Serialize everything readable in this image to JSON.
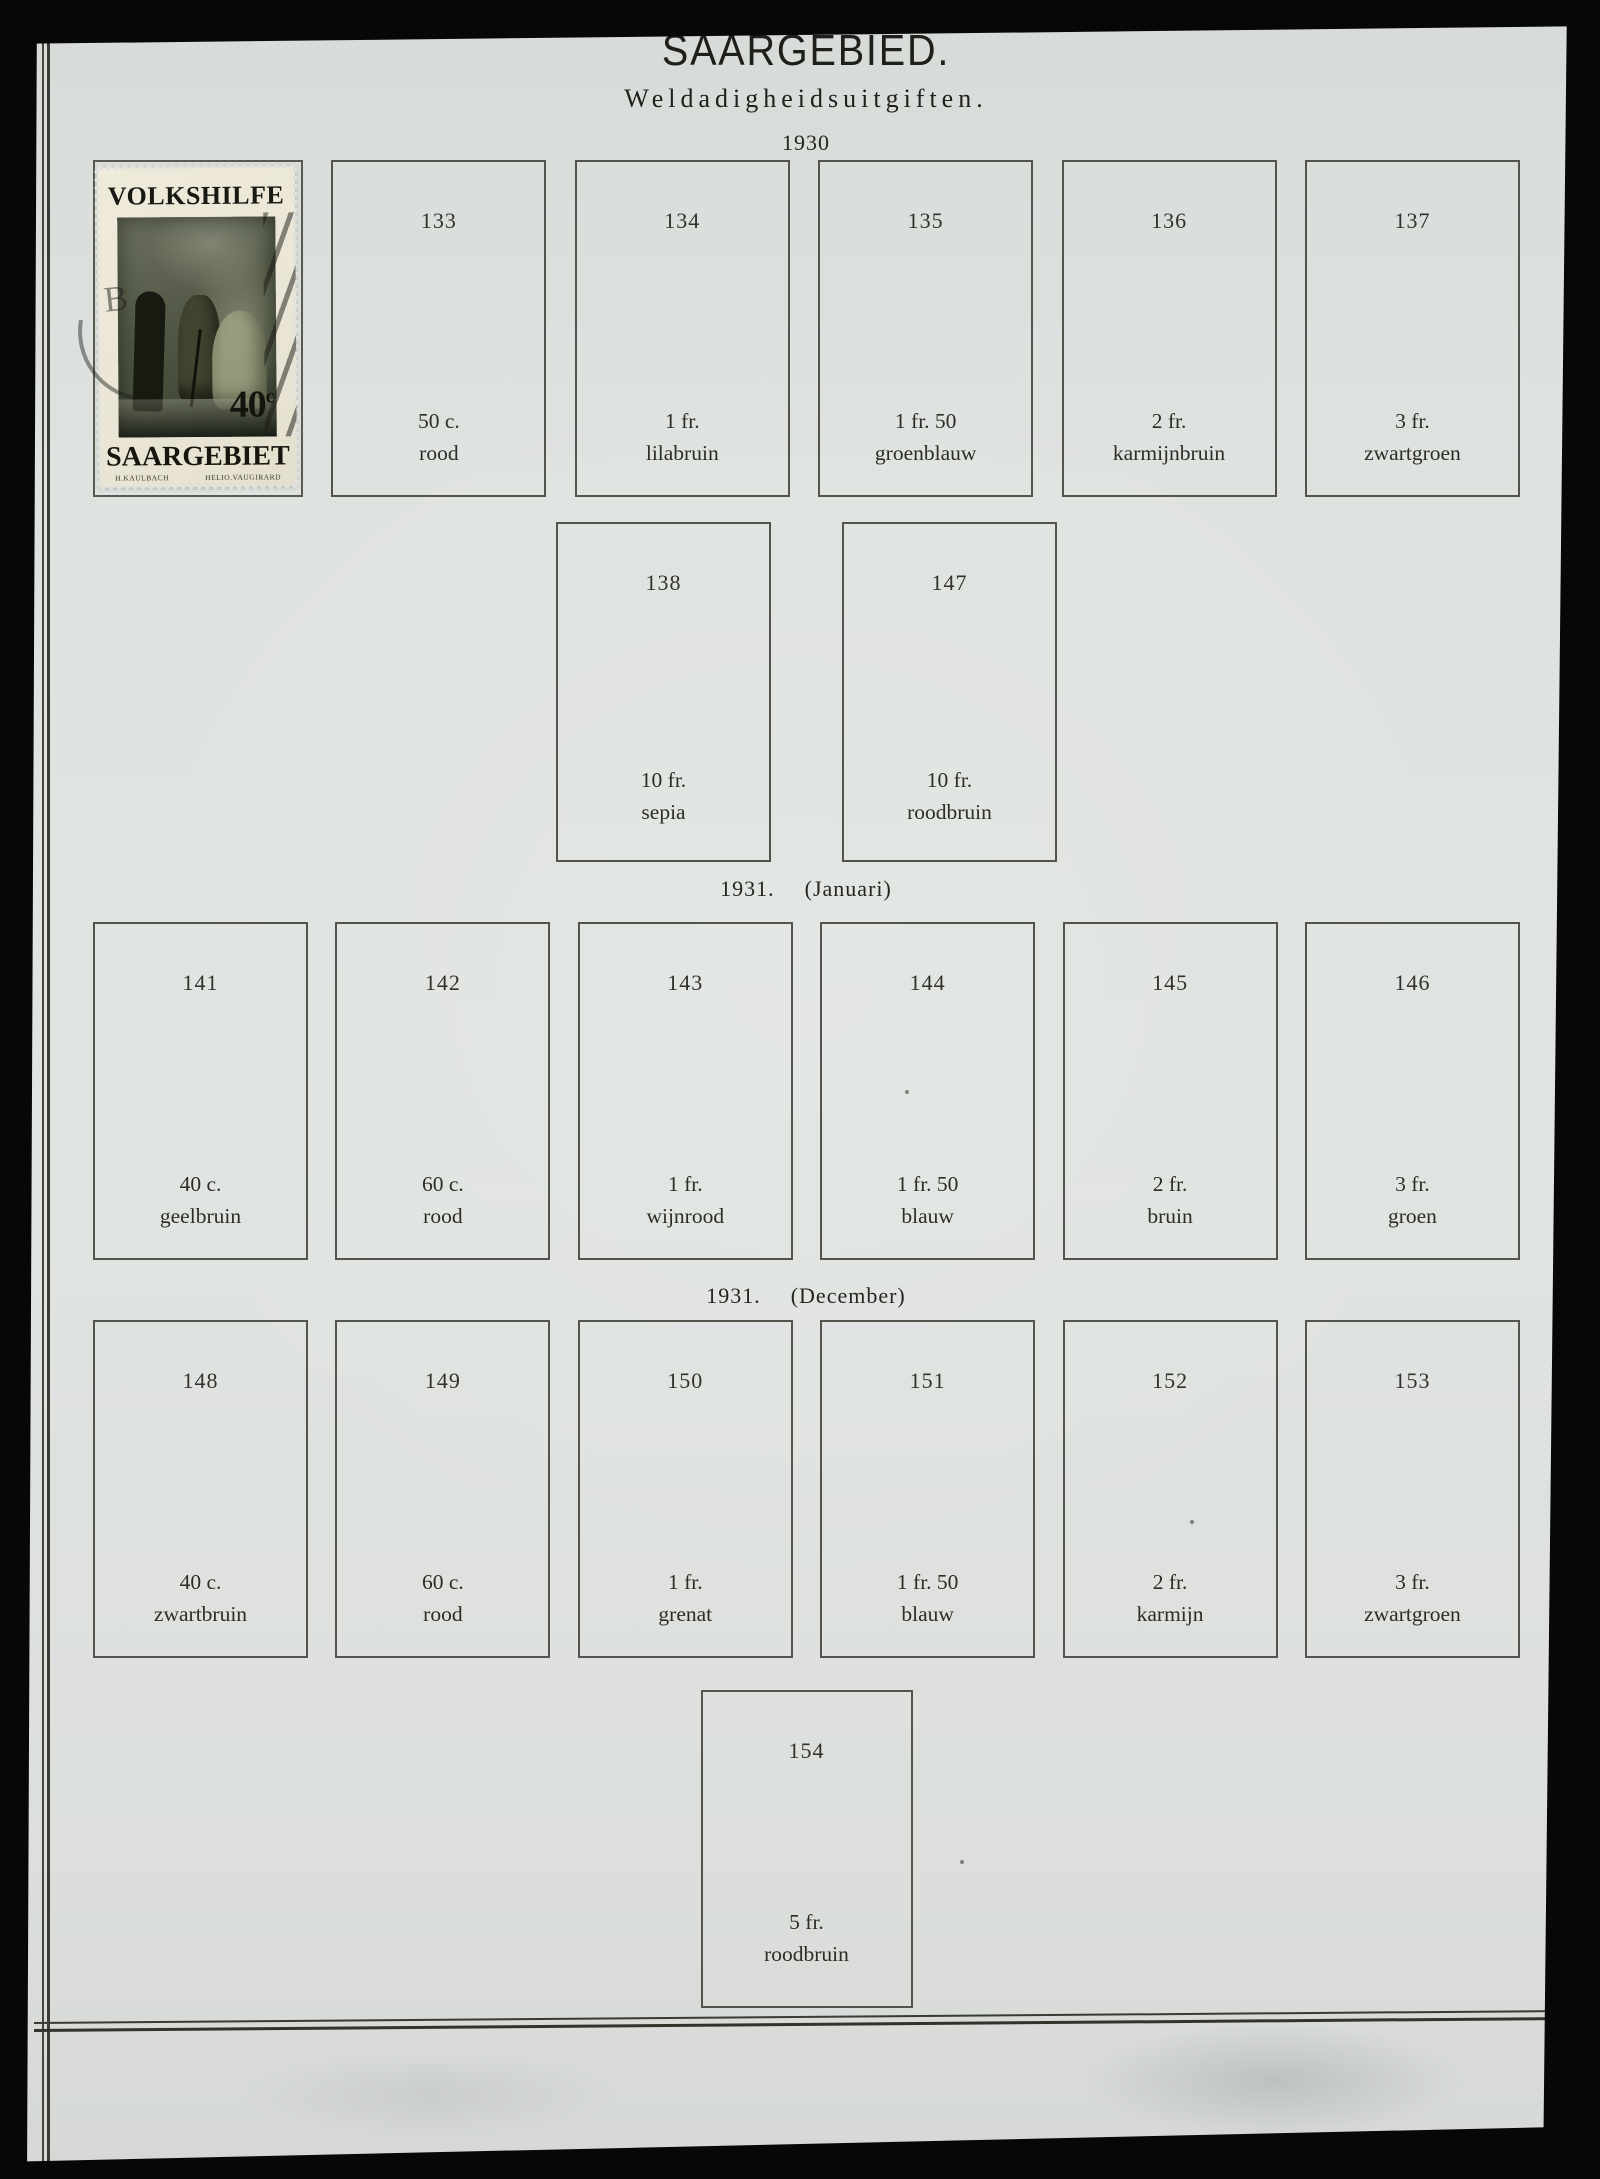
{
  "page": {
    "title": "SAARGEBIED.",
    "subtitle": "Weldadigheidsuitgiften.",
    "paper_color": "#dee2df",
    "ink_color": "#2d2d25",
    "box_border_color": "#55544c"
  },
  "stamp": {
    "top_text": "VOLKSHILFE",
    "denomination_value": "40",
    "denomination_unit": "c",
    "bottom_text": "SAARGEBIET",
    "imprint_left": "H.KAULBACH",
    "imprint_right": "HELIO.VAUGIRARD",
    "cancellation_letter": "B",
    "paper_color": "#ebe6d6",
    "image_color": "#4d5443"
  },
  "sections": [
    {
      "year_label": "1930",
      "rows": [
        {
          "boxes": [
            {
              "number": "133",
              "line1": "50 c.",
              "line2": "rood"
            },
            {
              "number": "134",
              "line1": "1 fr.",
              "line2": "lilabruin"
            },
            {
              "number": "135",
              "line1": "1 fr. 50",
              "line2": "groenblauw"
            },
            {
              "number": "136",
              "line1": "2 fr.",
              "line2": "karmijnbruin"
            },
            {
              "number": "137",
              "line1": "3 fr.",
              "line2": "zwartgroen"
            }
          ]
        },
        {
          "boxes": [
            {
              "number": "138",
              "line1": "10 fr.",
              "line2": "sepia"
            },
            {
              "number": "147",
              "line1": "10 fr.",
              "line2": "roodbruin"
            }
          ]
        }
      ]
    },
    {
      "year_label": "1931.",
      "month_label": "(Januari)",
      "rows": [
        {
          "boxes": [
            {
              "number": "141",
              "line1": "40 c.",
              "line2": "geelbruin"
            },
            {
              "number": "142",
              "line1": "60 c.",
              "line2": "rood"
            },
            {
              "number": "143",
              "line1": "1 fr.",
              "line2": "wijnrood"
            },
            {
              "number": "144",
              "line1": "1 fr. 50",
              "line2": "blauw"
            },
            {
              "number": "145",
              "line1": "2 fr.",
              "line2": "bruin"
            },
            {
              "number": "146",
              "line1": "3 fr.",
              "line2": "groen"
            }
          ]
        }
      ]
    },
    {
      "year_label": "1931.",
      "month_label": "(December)",
      "rows": [
        {
          "boxes": [
            {
              "number": "148",
              "line1": "40 c.",
              "line2": "zwartbruin"
            },
            {
              "number": "149",
              "line1": "60 c.",
              "line2": "rood"
            },
            {
              "number": "150",
              "line1": "1 fr.",
              "line2": "grenat"
            },
            {
              "number": "151",
              "line1": "1 fr. 50",
              "line2": "blauw"
            },
            {
              "number": "152",
              "line1": "2 fr.",
              "line2": "karmijn"
            },
            {
              "number": "153",
              "line1": "3 fr.",
              "line2": "zwartgroen"
            }
          ]
        },
        {
          "boxes": [
            {
              "number": "154",
              "line1": "5 fr.",
              "line2": "roodbruin"
            }
          ]
        }
      ]
    }
  ]
}
